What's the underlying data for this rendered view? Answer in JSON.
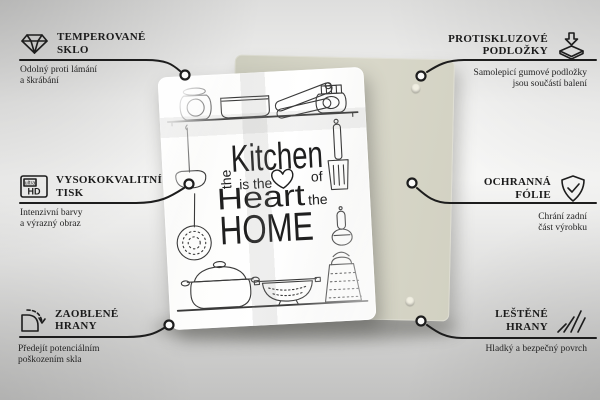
{
  "scene": {
    "background_color": "#ededec",
    "line_color": "#1d1d1d",
    "backing_board_color": "#d6d5c6",
    "glass_board_color": "#fcfcfb",
    "art_stroke_color": "#3a3a3a"
  },
  "product_design": {
    "word_the_vertical": "the",
    "word_kitchen": "Kitchen",
    "word_is_the": "is the",
    "word_of": "of",
    "word_heart": "Heart",
    "word_the_small": "the",
    "word_home": "HOME",
    "heart_icon": "heart-outline-icon"
  },
  "callouts": {
    "tempered_glass": {
      "icon": "diamond-icon",
      "title_line1": "TEMPEROVANÉ",
      "title_line2": "SKLO",
      "sub_line1": "Odolný proti lámání",
      "sub_line2": "a škrábání"
    },
    "high_quality_print": {
      "icon": "ultra-hd-icon",
      "icon_text_top": "ultra",
      "icon_text_bottom": "HD",
      "title_line1": "VYSOKOKVALITNÍ",
      "title_line2": "TISK",
      "sub_line1": "Intenzivní barvy",
      "sub_line2": "a výrazný obraz"
    },
    "rounded_edges": {
      "icon": "rounded-corner-icon",
      "title_line1": "ZAOBLENÉ",
      "title_line2": "HRANY",
      "sub_line1": "Předejít potenciálním",
      "sub_line2": "poškozením skla"
    },
    "anti_slip_pads": {
      "icon": "anti-slip-pad-icon",
      "title_line1": "PROTISKLUZOVÉ",
      "title_line2": "PODLOŽKY",
      "sub_line1": "Samolepicí gumové podložky",
      "sub_line2": "jsou součástí balení"
    },
    "protective_film": {
      "icon": "shield-check-icon",
      "title_line1": "OCHRANNÁ",
      "title_line2": "FÓLIE",
      "sub_line1": "Chrání zadní",
      "sub_line2": "část výrobku"
    },
    "polished_edges": {
      "icon": "polished-edge-icon",
      "title_line1": "LEŠTĚNÉ",
      "title_line2": "HRANY",
      "sub_line1": "Hladký a bezpečný povrch"
    }
  }
}
